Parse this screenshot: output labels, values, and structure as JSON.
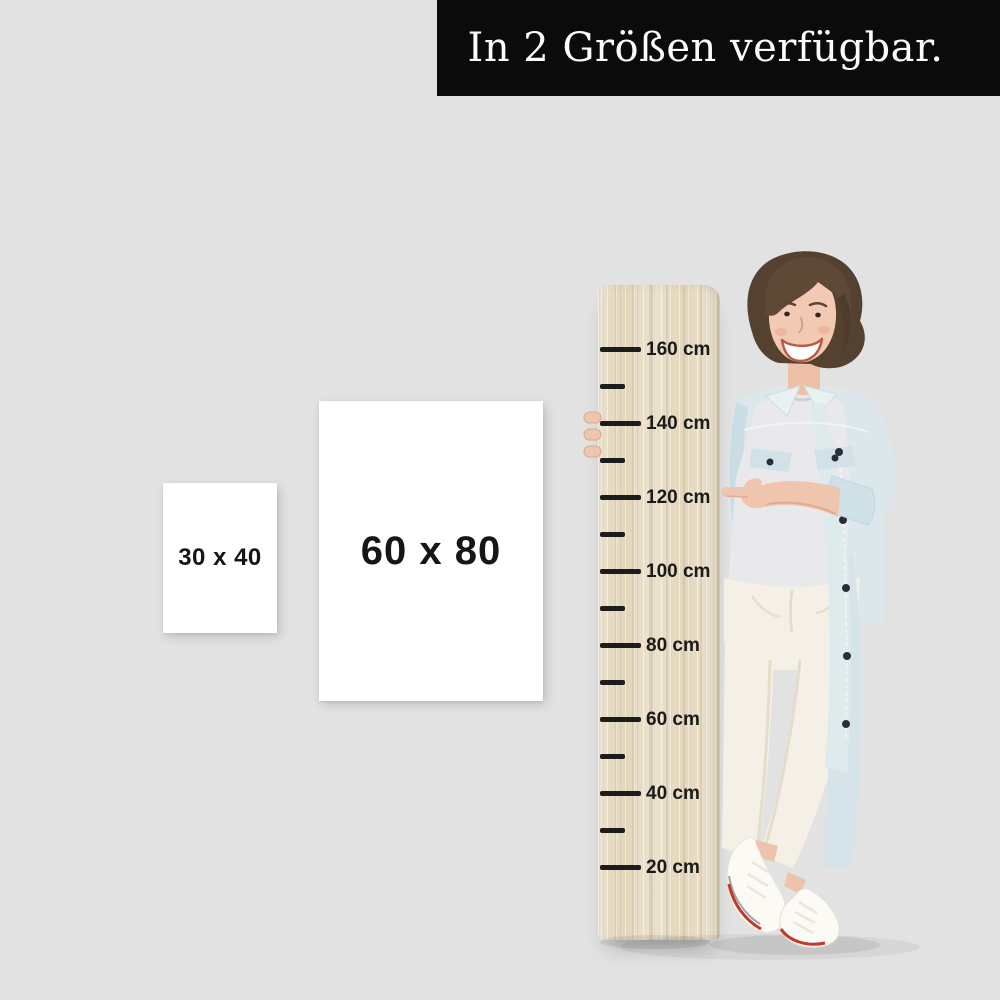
{
  "banner": {
    "text": "In 2 Größen verfügbar."
  },
  "size_options": {
    "small": {
      "label": "30 x 40"
    },
    "large": {
      "label": "60 x 80"
    }
  },
  "ruler": {
    "unit": "cm",
    "labels": [
      "160 cm",
      "140 cm",
      "120 cm",
      "100 cm",
      "80 cm",
      "60 cm",
      "40 cm",
      "20 cm"
    ]
  },
  "colors": {
    "background": "#e2e2e2",
    "banner_bg": "#0b0b0b",
    "banner_fg": "#fbfbfb",
    "size_box_bg": "#ffffff",
    "size_box_fg": "#161616",
    "wood": "#e8ddc6",
    "tick": "#1c1c1c",
    "denim_jacket": "#dbe7ea",
    "tee": "#e9e9ec",
    "pants": "#f4f0e6",
    "shoe_stripe_red": "#c0392b",
    "hair_brown": "#55412f",
    "skin": "#f2c9b2"
  }
}
